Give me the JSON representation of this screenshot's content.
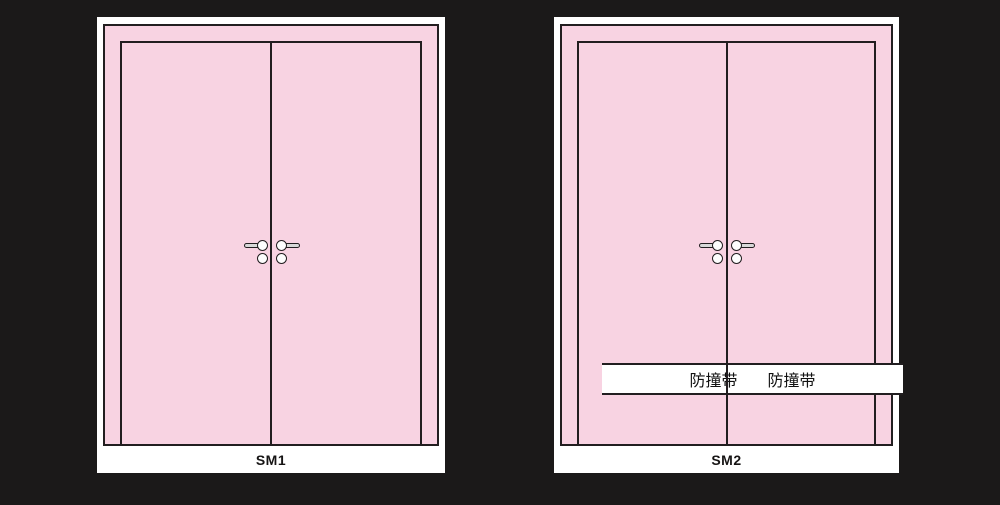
{
  "colors": {
    "background": "#1b1919",
    "panel_white": "#ffffff",
    "door_pink": "#f8d3e2",
    "outline": "#221e20",
    "handle_bar": "#d8d8d8",
    "handle_knob": "#fdfdfd"
  },
  "panels": [
    {
      "label": "SM1"
    },
    {
      "label": "SM2",
      "bump_strip": {
        "left_label": "防撞带",
        "right_label": "防撞带"
      }
    }
  ]
}
